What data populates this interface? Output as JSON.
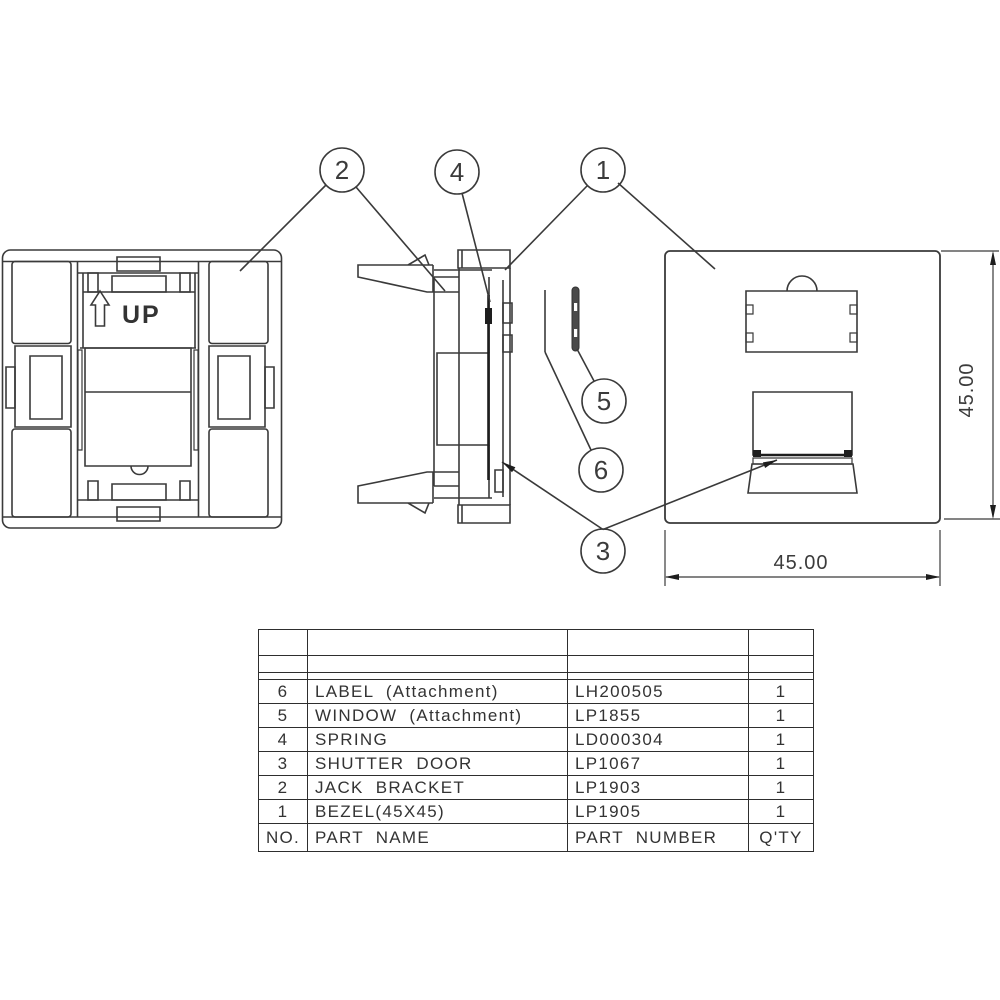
{
  "drawing": {
    "up_label": "UP",
    "dims": {
      "width": "45.00",
      "height": "45.00"
    },
    "callouts": {
      "c1": "1",
      "c2": "2",
      "c3": "3",
      "c4": "4",
      "c5": "5",
      "c6": "6"
    },
    "colors": {
      "line": "#3a3a3a",
      "dark": "#1e1e1e",
      "background": "#ffffff"
    }
  },
  "parts_table": {
    "headers": {
      "no": "NO.",
      "name": "PART  NAME",
      "number": "PART  NUMBER",
      "qty": "Q'TY"
    },
    "rows": [
      {
        "no": "6",
        "name": "LABEL  (Attachment)",
        "number": "LH200505",
        "qty": "1"
      },
      {
        "no": "5",
        "name": "WINDOW  (Attachment)",
        "number": "LP1855",
        "qty": "1"
      },
      {
        "no": "4",
        "name": "SPRING",
        "number": "LD000304",
        "qty": "1"
      },
      {
        "no": "3",
        "name": "SHUTTER  DOOR",
        "number": "LP1067",
        "qty": "1"
      },
      {
        "no": "2",
        "name": "JACK  BRACKET",
        "number": "LP1903",
        "qty": "1"
      },
      {
        "no": "1",
        "name": "BEZEL(45X45)",
        "number": "LP1905",
        "qty": "1"
      }
    ]
  }
}
